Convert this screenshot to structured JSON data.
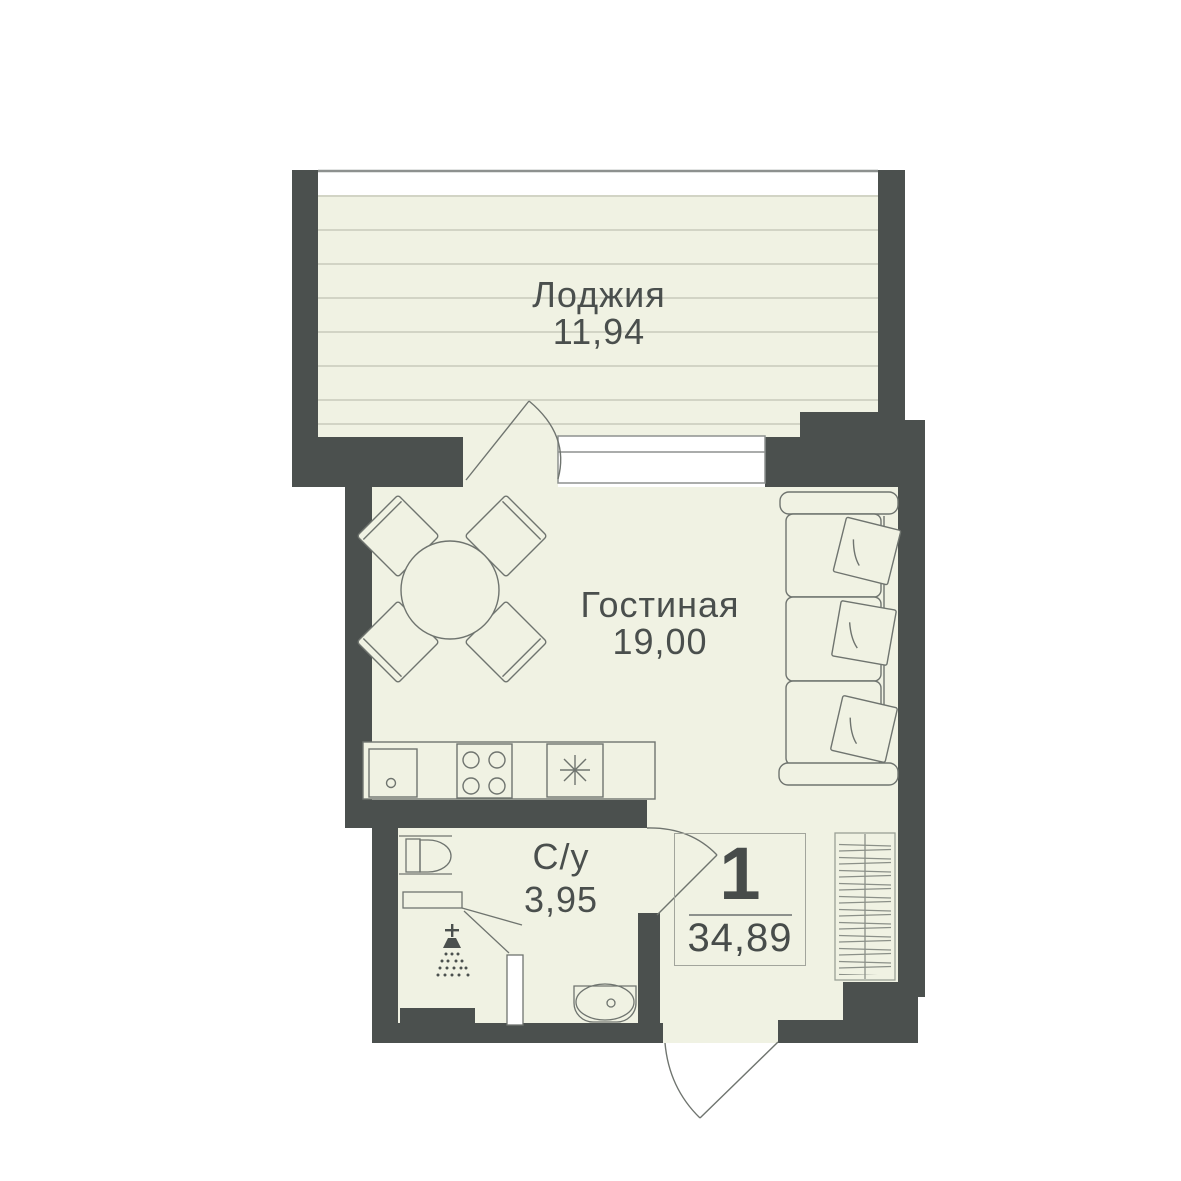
{
  "plan": {
    "rooms": [
      {
        "name": "Лоджия",
        "area": "11,94"
      },
      {
        "name": "Гостиная",
        "area": "19,00"
      },
      {
        "name": "С/у",
        "area": "3,95"
      }
    ],
    "summary": {
      "room_count": "1",
      "total_area": "34,89"
    },
    "colors": {
      "wall": "#4b504e",
      "floor": "#f0f2e3",
      "outline": "#6f746f",
      "background": "#ffffff"
    }
  }
}
